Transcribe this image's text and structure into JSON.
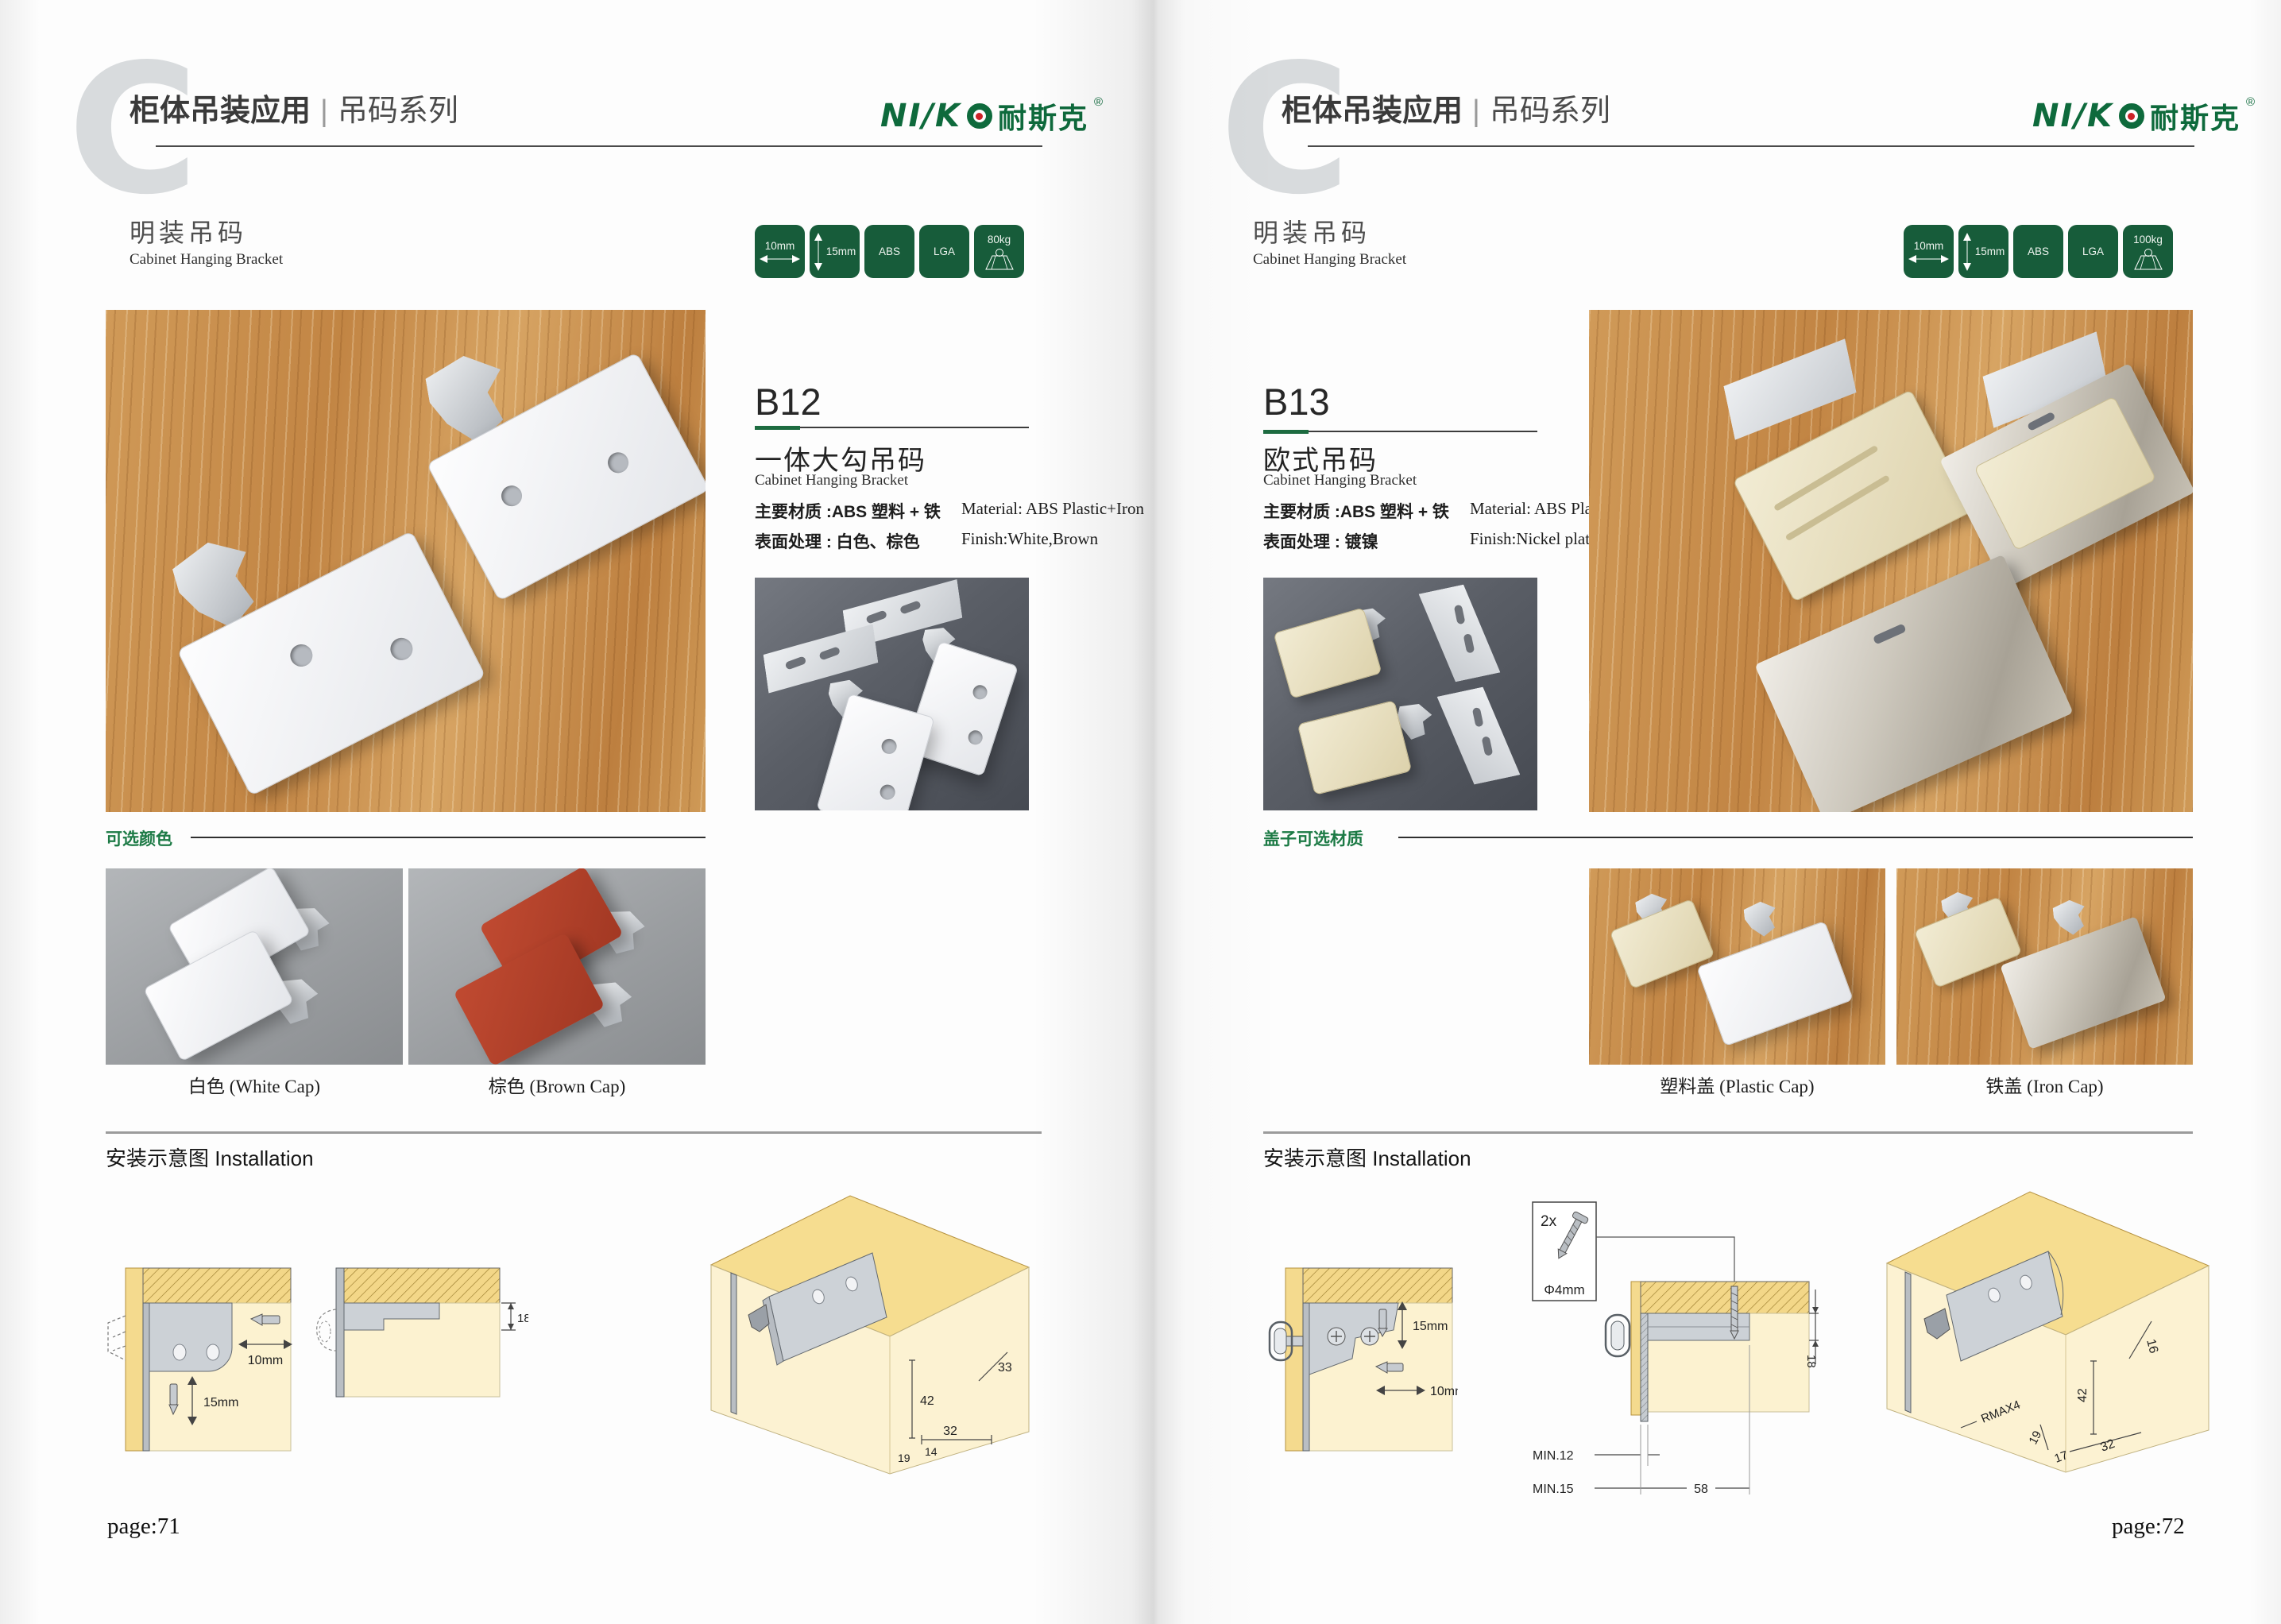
{
  "brand": {
    "logo_prefix": "NI/K",
    "logo_cjk": "耐斯克",
    "logo_reg": "®",
    "colors": {
      "brand_green": "#0e6a3c",
      "badge_green": "#175c3a",
      "accent_red": "#cc2227",
      "diagram_yellow": "#f6dd90",
      "diagram_cream": "#fcf2d2"
    }
  },
  "pages": [
    {
      "page_label": "page:71",
      "header": {
        "title_bold": "柜体吊装应用",
        "divider": "|",
        "title_light": "吊码系列"
      },
      "section": {
        "title_cn": "明装吊码",
        "title_en": "Cabinet Hanging Bracket"
      },
      "badges": {
        "width_label": "10mm",
        "height_label": "15mm",
        "material_label": "ABS",
        "cert_label": "LGA",
        "load_label": "80kg"
      },
      "product": {
        "code": "B12",
        "name_cn": "一体大勾吊码",
        "name_en": "Cabinet Hanging Bracket",
        "material_cn": "主要材质 :ABS 塑料 + 铁",
        "material_en": "Material: ABS Plastic+Iron",
        "finish_cn": "表面处理 : 白色、棕色",
        "finish_en": "Finish:White,Brown"
      },
      "options": {
        "title": "可选颜色",
        "item1_label": "白色 (White Cap)",
        "item2_label": "棕色 (Brown Cap)"
      },
      "installation": {
        "title": "安装示意图 Installation",
        "d1_width": "10mm",
        "d1_height": "15mm",
        "d2_dim": "18",
        "d3_dims": {
          "a": "33",
          "b": "42",
          "c": "32",
          "d": "14",
          "e": "19"
        }
      }
    },
    {
      "page_label": "page:72",
      "header": {
        "title_bold": "柜体吊装应用",
        "divider": "|",
        "title_light": "吊码系列"
      },
      "section": {
        "title_cn": "明装吊码",
        "title_en": "Cabinet Hanging Bracket"
      },
      "badges": {
        "width_label": "10mm",
        "height_label": "15mm",
        "material_label": "ABS",
        "cert_label": "LGA",
        "load_label": "100kg"
      },
      "product": {
        "code": "B13",
        "name_cn": "欧式吊码",
        "name_en": "Cabinet Hanging Bracket",
        "material_cn": "主要材质 :ABS 塑料 + 铁",
        "material_en": "Material: ABS Plastic+Iron",
        "finish_cn": "表面处理 : 镀镍",
        "finish_en": "Finish:Nickel plating"
      },
      "options": {
        "title": "盖子可选材质",
        "item1_label": "塑料盖 (Plastic Cap)",
        "item2_label": "铁盖 (Iron Cap)"
      },
      "installation": {
        "title": "安装示意图 Installation",
        "d1_height": "15mm",
        "d1_width": "10mm",
        "screw_count": "2x",
        "screw_dia": "Φ4mm",
        "d2_dim": "18",
        "d2_min1": "MIN.12",
        "d2_min2": "MIN.15",
        "d2_span": "58",
        "d3_dims": {
          "a": "16",
          "b": "42",
          "r": "RMAX4",
          "c": "19",
          "d": "17",
          "e": "32"
        }
      }
    }
  ]
}
